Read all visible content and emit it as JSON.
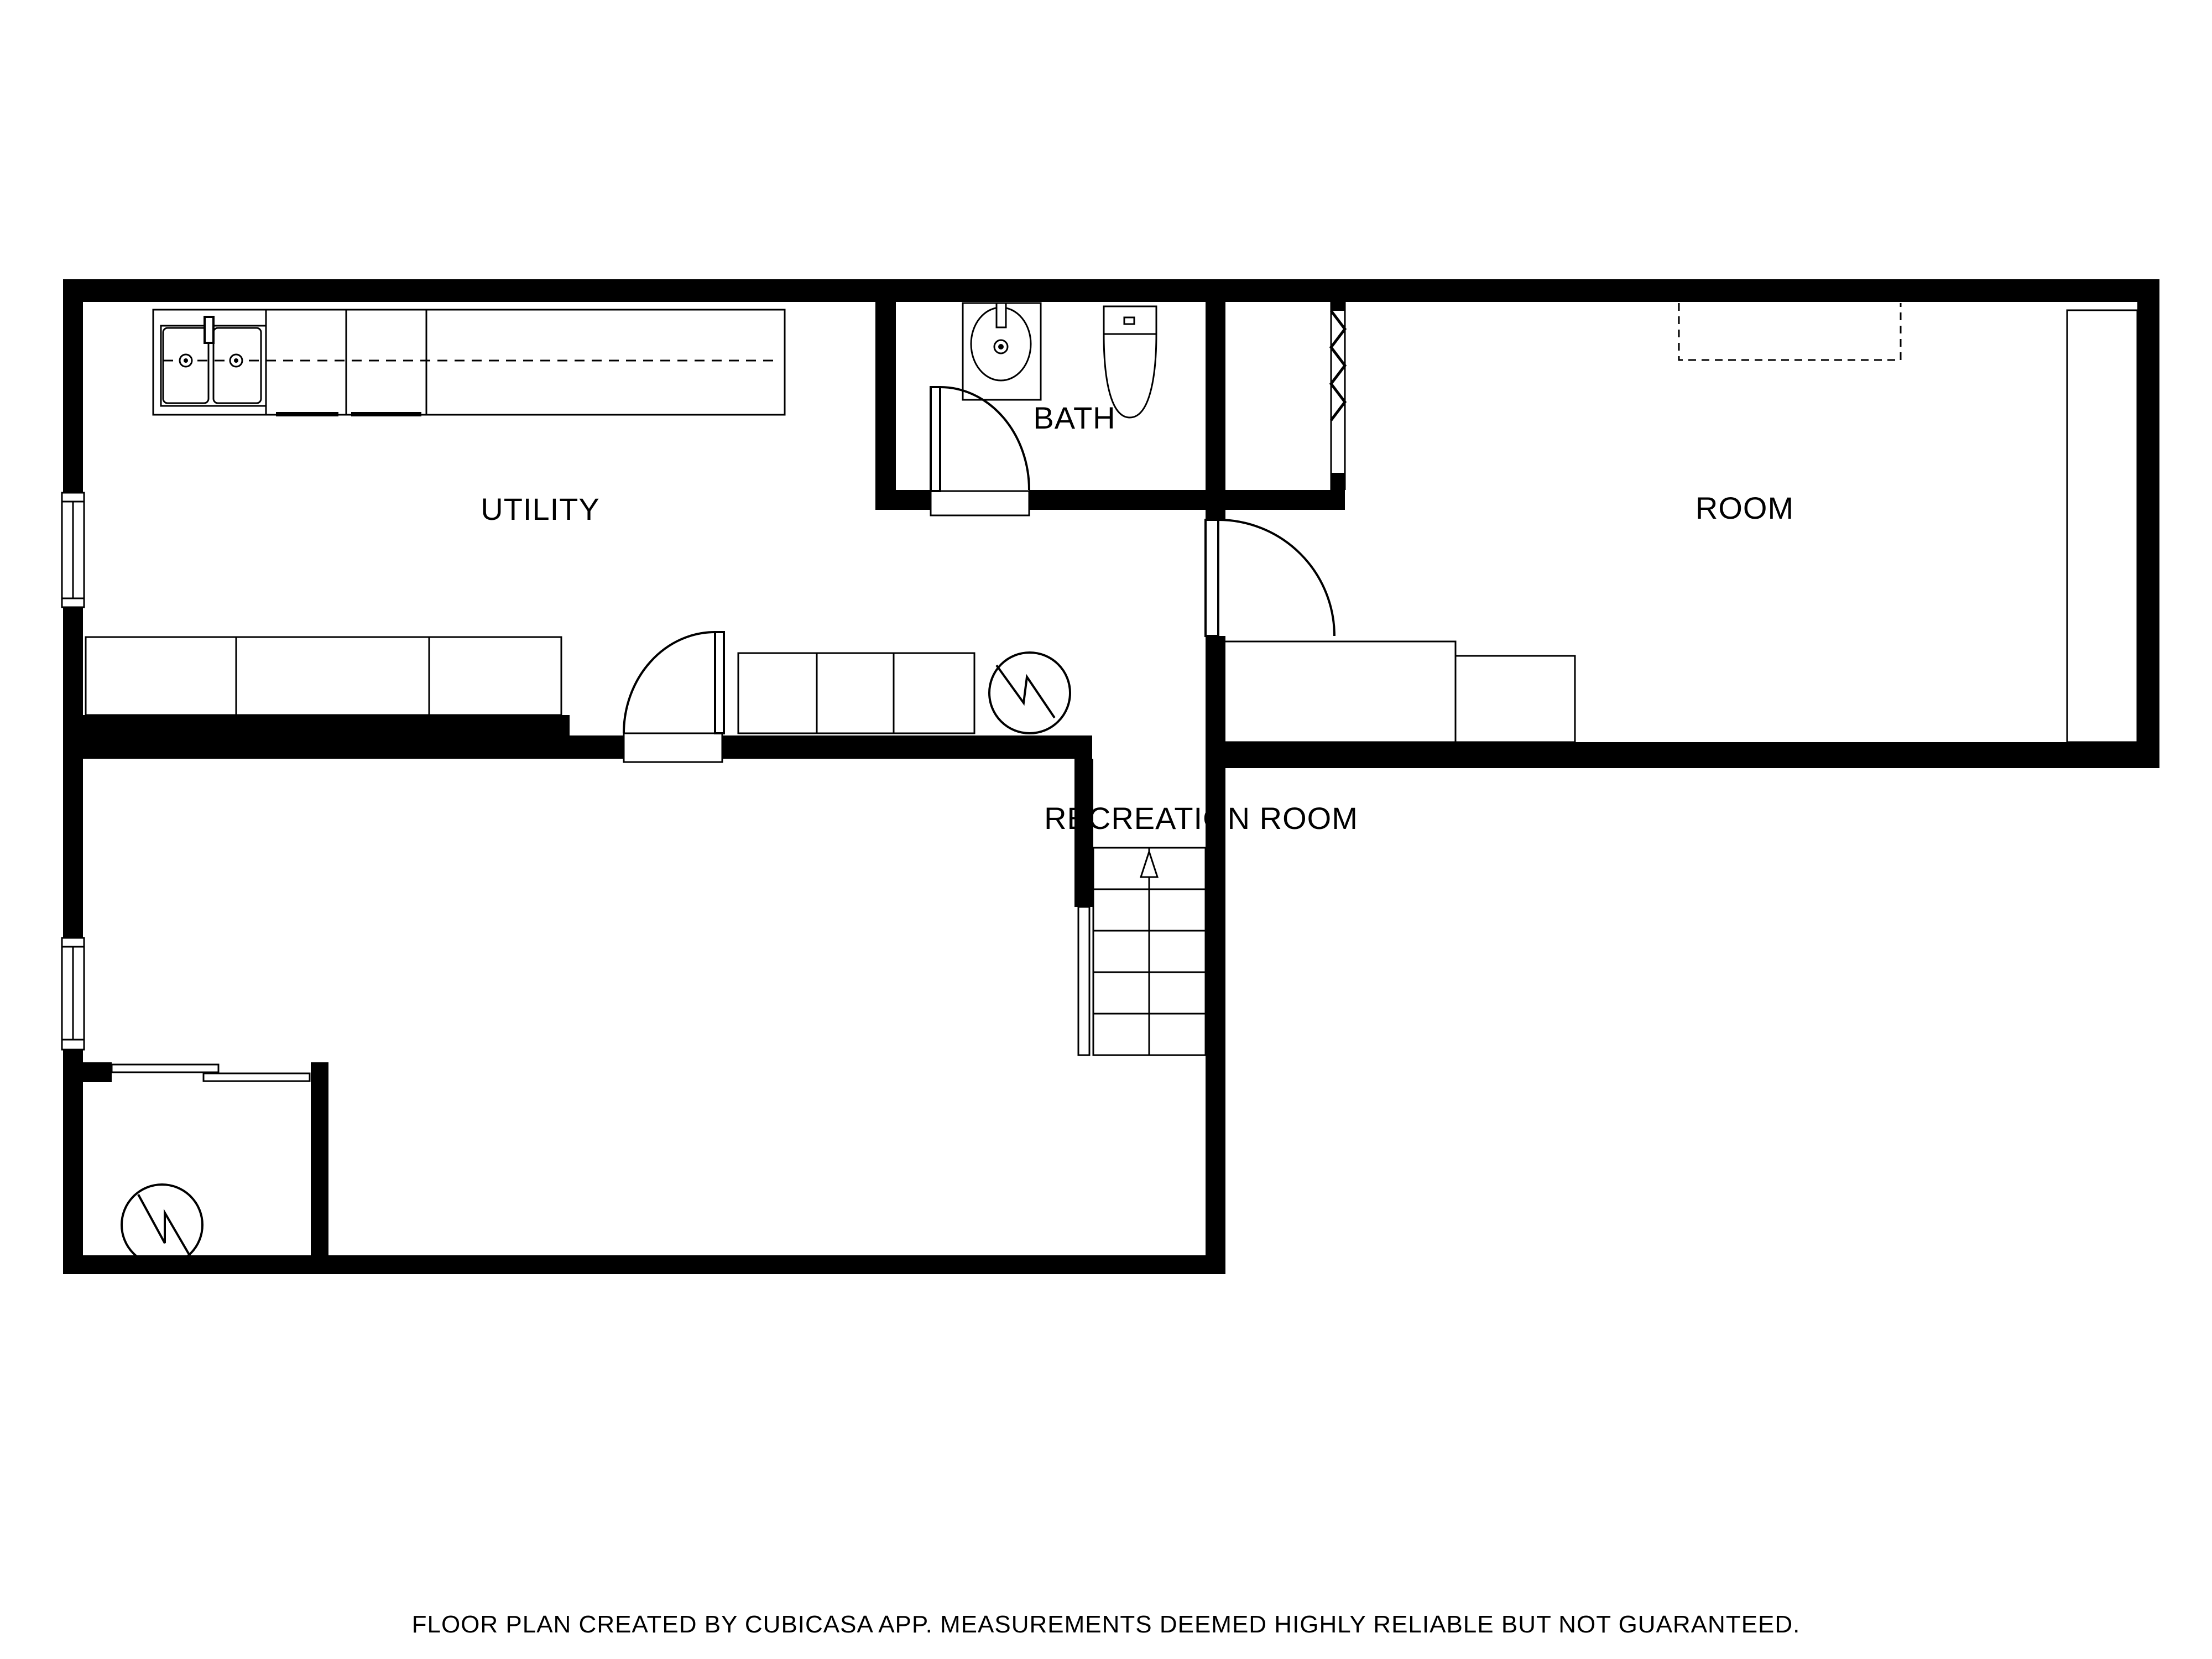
{
  "page": {
    "type": "floor-plan",
    "background_color": "#ffffff",
    "wall_color": "#000000",
    "line_color": "#000000"
  },
  "labels": {
    "utility": "UTILITY",
    "bath": "BATH",
    "room": "ROOM",
    "recreation": "RECREATION ROOM"
  },
  "caption": "FLOOR PLAN CREATED BY CUBICASA APP. MEASUREMENTS DEEMED HIGHLY RELIABLE BUT NOT GUARANTEED.",
  "stairs": {
    "step_rows": 5,
    "arrow_direction": "up"
  },
  "fixtures": {
    "kitchen_sink": "double-basin sink with faucet",
    "bath_sink": "oval basin vanity with faucet",
    "toilet": "tank with elongated bowl",
    "water_heaters": 2,
    "windows": 2,
    "doors": [
      "bath swing door",
      "utility swing door",
      "room swing door",
      "closet sliding door"
    ],
    "wall_opening": "zigzag opening symbol"
  }
}
